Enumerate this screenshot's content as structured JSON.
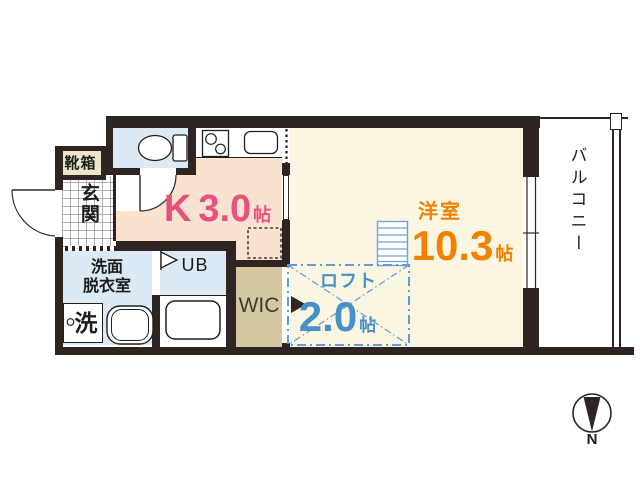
{
  "floorplan": {
    "entrance": {
      "label": "玄関"
    },
    "shoe_box": {
      "label": "靴箱"
    },
    "kitchen": {
      "label": "K",
      "size": "3.0",
      "unit": "帖"
    },
    "washroom": {
      "line1": "洗面",
      "line2": "脱衣室"
    },
    "washer": {
      "label": "洗"
    },
    "unit_bath": {
      "label": "UB"
    },
    "wic": {
      "label": "WIC"
    },
    "main_room": {
      "label": "洋室",
      "size": "10.3",
      "unit": "帖"
    },
    "loft": {
      "label": "ロフト",
      "size": "2.0",
      "unit": "帖"
    },
    "balcony": {
      "label": "バルコニー"
    },
    "compass": {
      "label": "N"
    },
    "colors": {
      "wall": "#2e2522",
      "kitchen_floor": "#fae2d1",
      "main_room_floor": "#faf6e2",
      "wet_area_floor": "#dbeaf4",
      "wic_floor": "#d5c8a0",
      "shoe_box_fill": "#eae5cb",
      "kitchen_text": "#e8517e",
      "main_room_text": "#ef8200",
      "loft_text": "#4790c8",
      "loft_line": "#5d9cd6"
    }
  }
}
